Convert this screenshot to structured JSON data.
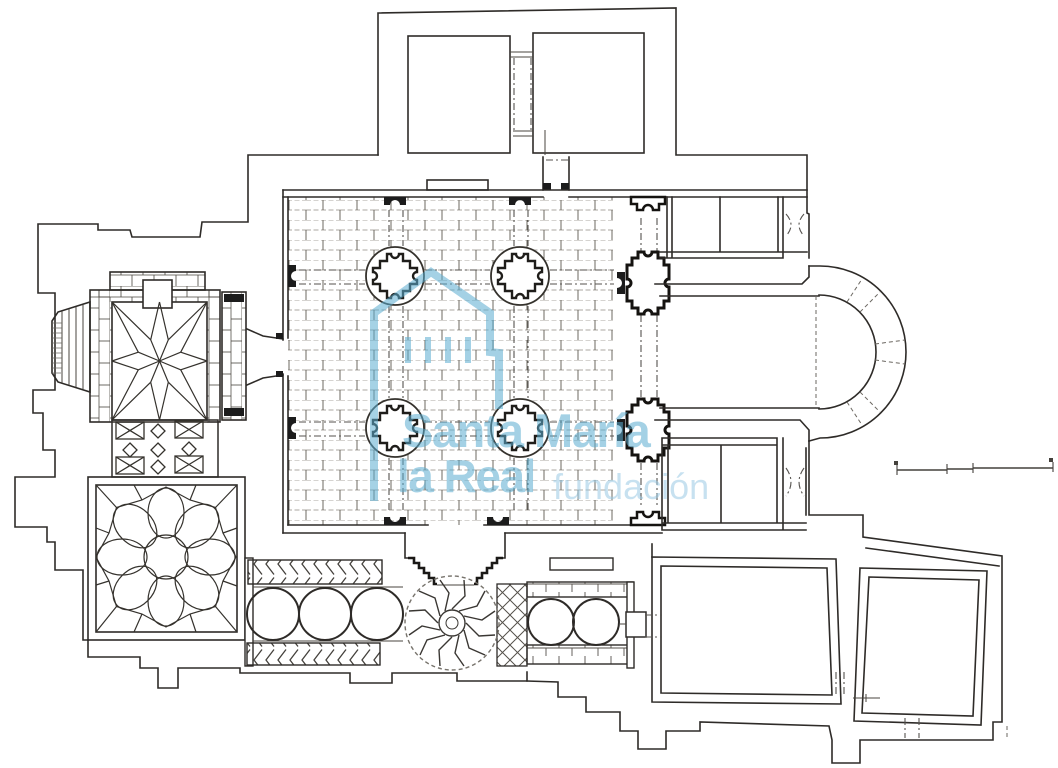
{
  "document": {
    "kind": "architectural floor plan line drawing",
    "background": "#ffffff",
    "ink_color": "#2e2b28"
  },
  "watermark": {
    "logo_icon": "house-outline-logo",
    "title_line1": "Santa María",
    "title_line2": "la Real",
    "subtitle": "fundación",
    "brand_color": "#5badd0",
    "subtitle_color": "#9bcae4",
    "overlay_opacity": 0.55
  },
  "plan_features": [
    "west-enclosure-walls",
    "bell-tower-star-vault",
    "stair-turret",
    "checkerboard-vestibule",
    "rosette-vault-chapel",
    "nave-masonry-floor",
    "quatrefoil-columns",
    "cruciform-piers",
    "north-annex-rooms",
    "north-chapel",
    "chancel",
    "horseshoe-apse",
    "south-chapel",
    "stepped-portal",
    "portico-gallery",
    "radial-wheel-vault",
    "lattice-panel",
    "southeast-rooms",
    "scale-bar"
  ],
  "scale_bar": {
    "segments": 3,
    "labels_visible": false
  }
}
